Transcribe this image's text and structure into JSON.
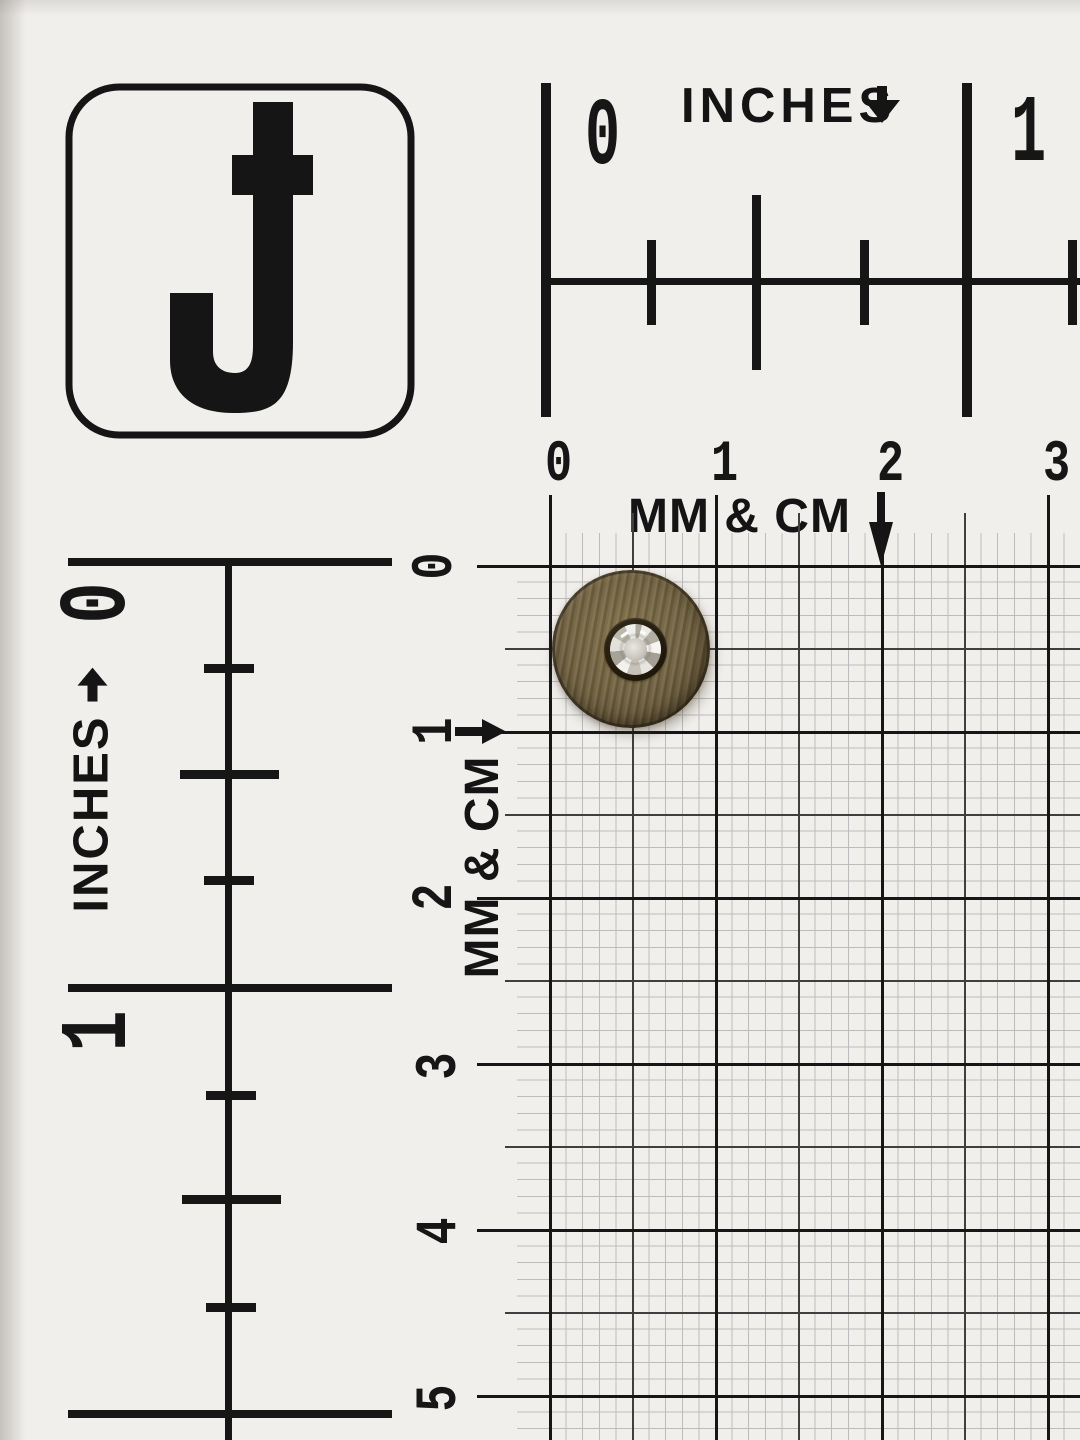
{
  "scene": {
    "description": "Round antique brass button with clear rhinestone center lying on a black and white measuring grid card",
    "logo": {
      "letter": "J"
    },
    "top_inch_ruler": {
      "label": "INCHES",
      "numbers": [
        "0",
        "1"
      ]
    },
    "top_cm_scale": {
      "label": "MM & CM",
      "numbers": [
        "0",
        "1",
        "2",
        "3"
      ]
    },
    "left_inch_ruler": {
      "label": "INCHES",
      "numbers": [
        "0",
        "1"
      ]
    },
    "left_cm_scale": {
      "label": "MM & CM",
      "numbers": [
        "0",
        "1",
        "2",
        "3",
        "4",
        "5"
      ]
    },
    "button": {
      "material": "antique brass",
      "center": "clear rhinestone",
      "measured_diameter_mm": 9.5
    },
    "colors": {
      "paper": "#f1efec",
      "ink": "#161616",
      "grid_mm_line": "#bcbcbc",
      "grid_5mm_line": "#3f3f3f",
      "brass_light": "#8a7a52",
      "brass_mid": "#6e6040",
      "brass_dark": "#41361f",
      "bezel": "#241d11",
      "stone": "#dedbd5"
    }
  }
}
